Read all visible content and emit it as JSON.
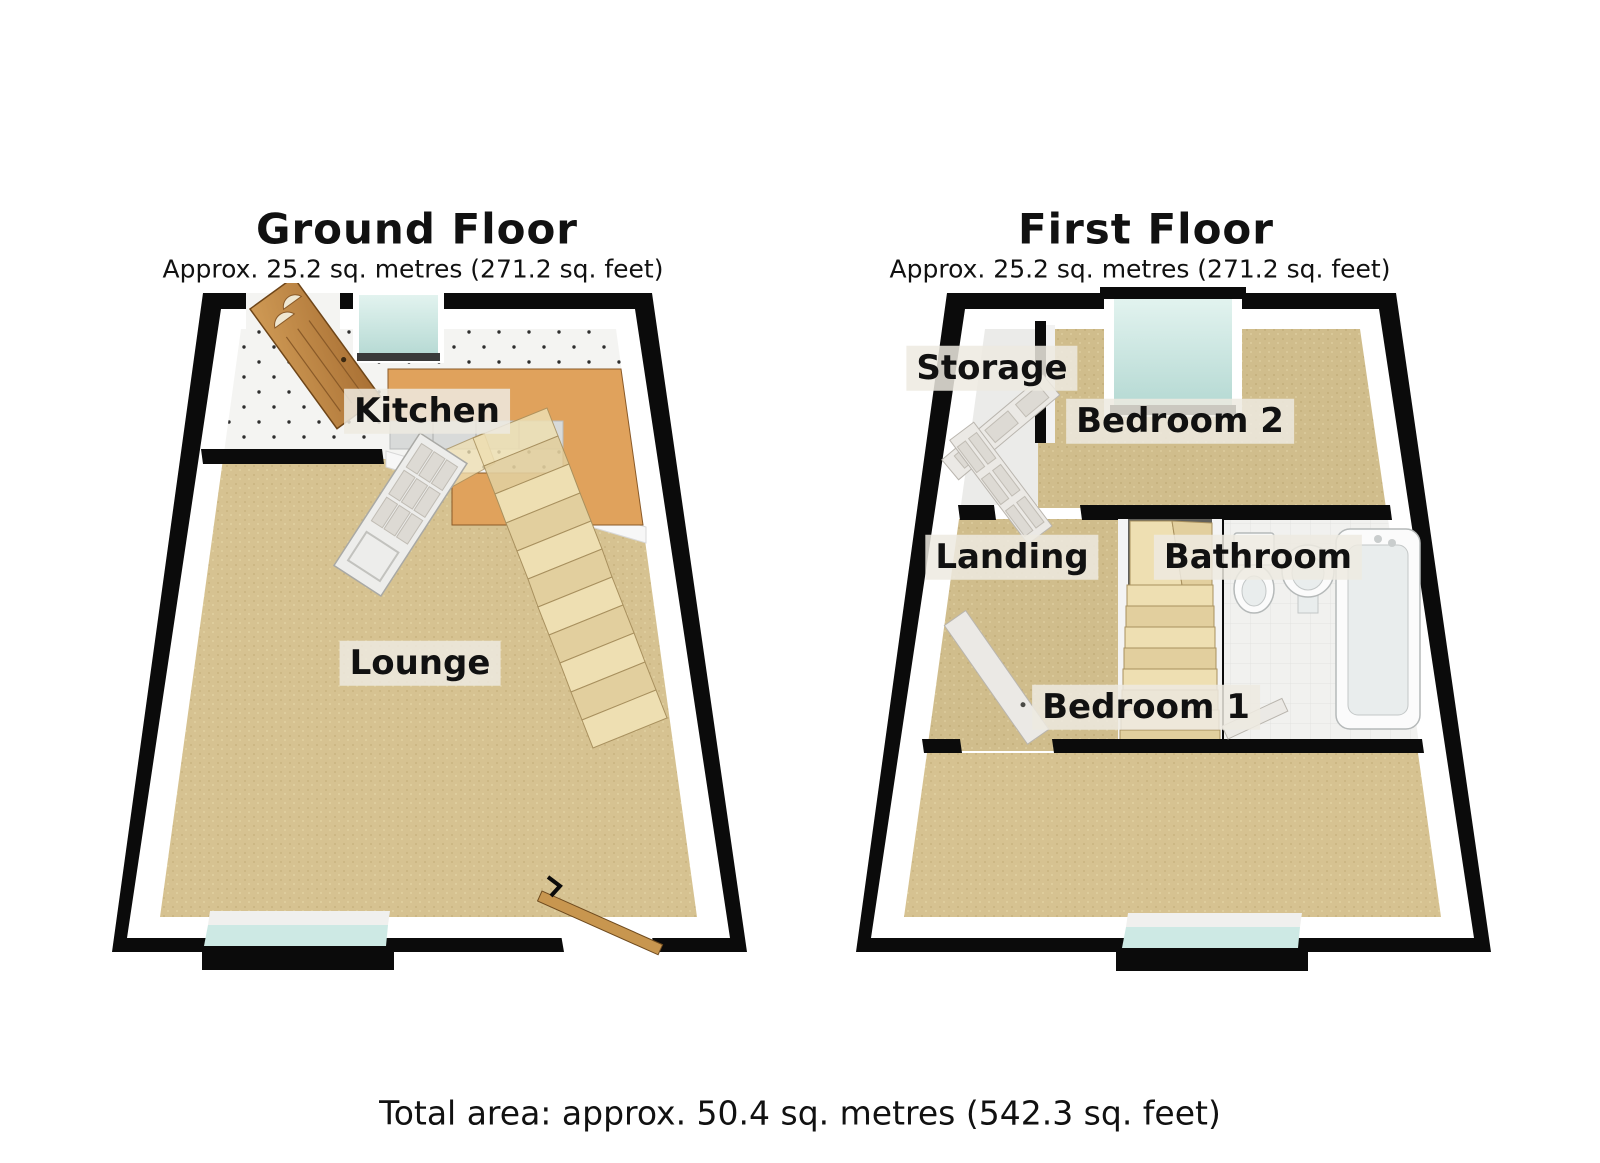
{
  "ground_floor": {
    "title": "Ground Floor",
    "subtitle": "Approx. 25.2 sq. metres (271.2 sq. feet)",
    "rooms": [
      {
        "label": "Kitchen"
      },
      {
        "label": "Lounge"
      }
    ]
  },
  "first_floor": {
    "title": "First Floor",
    "subtitle": "Approx. 25.2 sq. metres (271.2 sq. feet)",
    "rooms": [
      {
        "label": "Storage"
      },
      {
        "label": "Bedroom 2"
      },
      {
        "label": "Landing"
      },
      {
        "label": "Bathroom"
      },
      {
        "label": "Bedroom 1"
      }
    ]
  },
  "footer": {
    "total_area": "Total area: approx. 50.4 sq. metres (542.3 sq. feet)"
  },
  "colors": {
    "wall": "#0b0b0b",
    "carpet": "#d6c291",
    "tile": "#f4f4f2",
    "wood": "#e0a25c",
    "glass": "#cde9e4",
    "stair": "#eedfb2",
    "label_bg": "#edeae0",
    "ink": "#111111"
  }
}
